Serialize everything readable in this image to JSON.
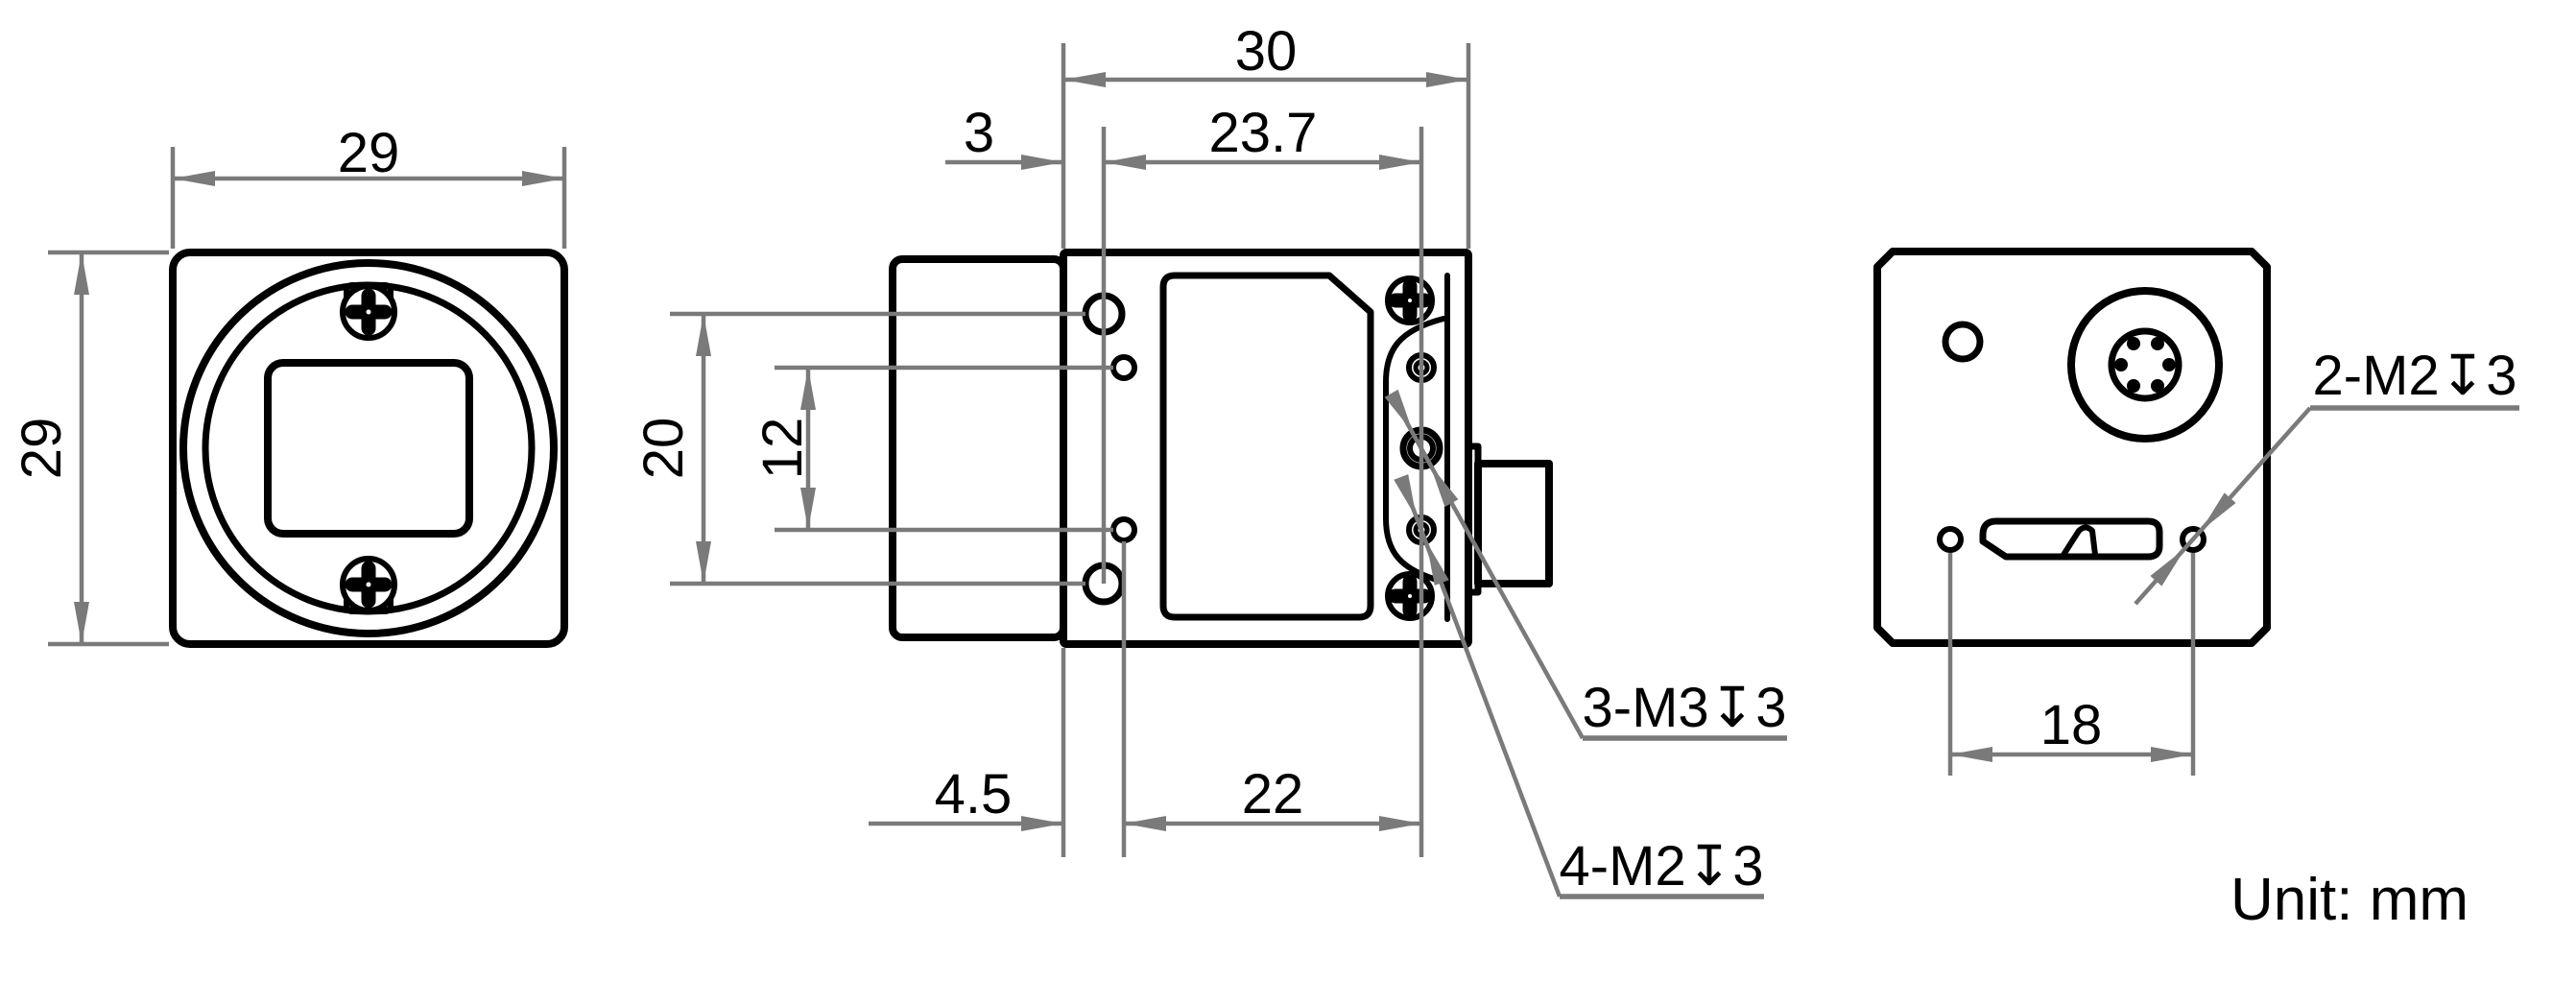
{
  "drawing": {
    "title": "camera-dimensional-drawing",
    "unit_note": "Unit: mm",
    "colors": {
      "line": "#000000",
      "dim": "#7a7a7a",
      "background": "#ffffff"
    },
    "front_view": {
      "width_mm": "29",
      "height_mm": "29"
    },
    "side_view": {
      "depth_mm": "30",
      "front_hole_offset_mm": "3",
      "hole_span_mm": "23.7",
      "hole_pitch_outer_mm": "20",
      "hole_pitch_inner_mm": "12",
      "bottom_offset_mm": "4.5",
      "bottom_span_mm": "22",
      "m3_callout": "3-M3↧3",
      "m2_callout": "4-M2↧3"
    },
    "rear_view": {
      "hole_pitch_mm": "18",
      "m2_callout": "2-M2↧3"
    }
  }
}
